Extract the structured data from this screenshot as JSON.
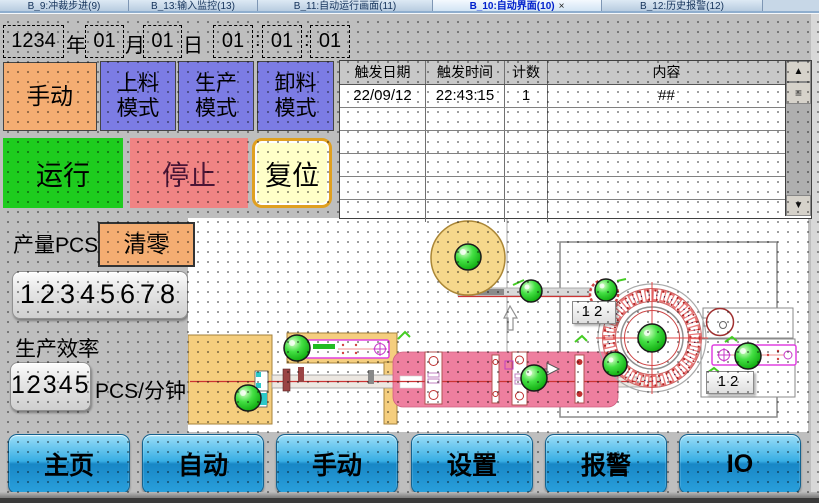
{
  "tabs": {
    "items": [
      {
        "label": "B_9:冲裁步进(9)",
        "active": false
      },
      {
        "label": "B_13:输入监控(13)",
        "active": false
      },
      {
        "label": "B_11:自动运行画面(11)",
        "active": false
      },
      {
        "label": "B_10:自动界面(10)",
        "active": true,
        "close_glyph": "×"
      },
      {
        "label": "B_12:历史报警(12)",
        "active": false
      }
    ]
  },
  "datetime": {
    "year": "1234",
    "year_unit": "年",
    "month": "01",
    "month_unit": "月",
    "day": "01",
    "day_unit": "日",
    "hour": "01",
    "minute": "01",
    "second": "01",
    "separator": ":"
  },
  "modes": {
    "manual": "手动",
    "feed": {
      "line1": "上料",
      "line2": "模式"
    },
    "production": {
      "line1": "生产",
      "line2": "模式"
    },
    "unload": {
      "line1": "卸料",
      "line2": "模式"
    }
  },
  "run_controls": {
    "run": "运行",
    "stop": "停止",
    "reset": "复位"
  },
  "production": {
    "count_label": "产量PCS",
    "clear_button": "清零",
    "count_value": "12345678",
    "rate_label": "生产效率",
    "rate_value": "12345",
    "rate_unit": "PCS/分钟"
  },
  "alarm_table": {
    "headers": [
      "触发日期",
      "触发时间",
      "计数",
      "内容"
    ],
    "rows": [
      {
        "date": "22/09/12",
        "time": "22:43:15",
        "count": "1",
        "content": "##"
      }
    ],
    "scrollbar": {
      "up": "▲",
      "down": "▼",
      "grip": "≡"
    }
  },
  "diagram": {
    "counter_left": "12",
    "counter_right": "12",
    "lamp_on_color": "#2FD42F"
  },
  "nav": {
    "items": [
      "主页",
      "自动",
      "手动",
      "设置",
      "报警",
      "IO"
    ]
  },
  "colors": {
    "accent_orange": "#F4AD72",
    "accent_blue": "#7C7CE4",
    "run_green": "#1ECC1E",
    "stop_red": "#F08484",
    "stop_text": "#4A1535",
    "reset_yellow": "#FFFFC8",
    "nav_blue": "#2AA0DC",
    "bed_pink": "#EE7F9F",
    "reel_yellow": "#F5CE7E",
    "magenta": "#FF00FF"
  }
}
